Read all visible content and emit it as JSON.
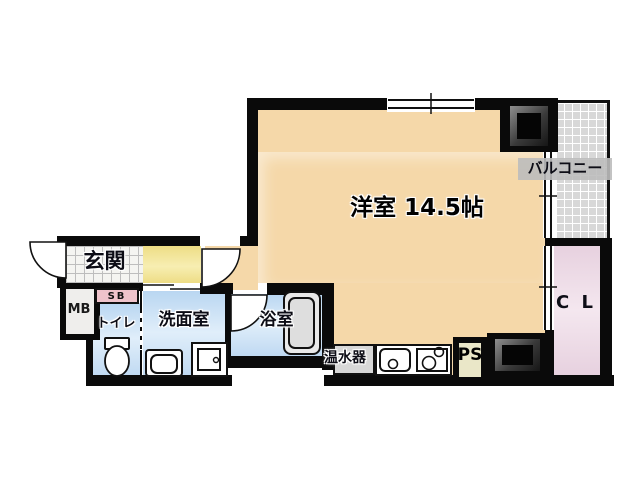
{
  "floor_plan": {
    "main_room": {
      "label": "洋室 14.5帖"
    },
    "balcony": {
      "label": "バルコニー"
    },
    "closet": {
      "label": "C L"
    },
    "entrance": {
      "label": "玄関"
    },
    "washroom": {
      "label": "洗面室"
    },
    "bathroom": {
      "label": "浴室"
    },
    "toilet": {
      "label": "トイレ"
    },
    "water_heater": {
      "label": "温水器"
    },
    "pipe_space": {
      "label": "PS"
    },
    "meter_box": {
      "label": "MB"
    },
    "shoe_box": {
      "label": "SB"
    }
  },
  "colors": {
    "room_floor": "#f5d8a9",
    "hallway_floor": "#f1e18e",
    "wet_area_floor": "#c5ddf4",
    "closet_floor": "#ebd5e2",
    "balcony_floor": "#d8d8d8",
    "shoe_box_fill": "#efc3cb",
    "pipe_space_fill": "#eae7c8",
    "water_heater_fill": "#d7d7d7",
    "wall": "#0a0a0a"
  }
}
